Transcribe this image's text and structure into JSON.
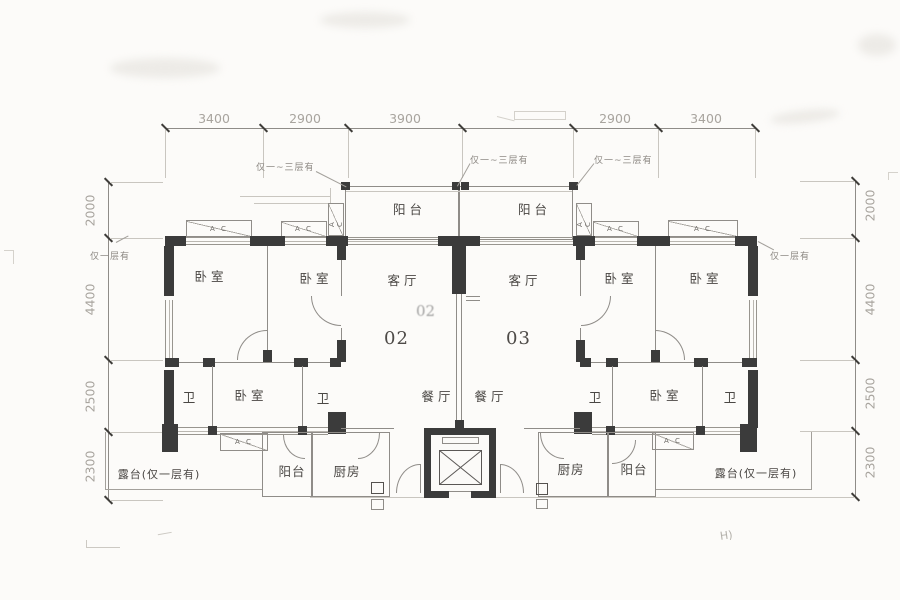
{
  "drawing_type": "apartment floor plan",
  "colors": {
    "background": "#fcfbf9",
    "wall": "#3b3b3b",
    "line": "#8f8c88",
    "light_line": "#c9c6c0",
    "dim_text": "#a8a49e",
    "label_text": "#4a4744"
  },
  "dimensions": {
    "top": [
      "3400",
      "2900",
      "3900",
      "2900",
      "3400"
    ],
    "left": [
      "2000",
      "4400",
      "2500",
      "2300"
    ],
    "right": [
      "2000",
      "4400",
      "2500",
      "2300"
    ]
  },
  "units": {
    "left": "02",
    "right": "03",
    "ghost": "02"
  },
  "rooms": {
    "bedroom": "卧室",
    "living_room": "客厅",
    "dining_room": "餐厅",
    "bathroom": "卫",
    "kitchen": "厨房",
    "balcony": "阳台",
    "terrace": "露台(仅一层有)"
  },
  "equipment": {
    "ac_unit": "A C"
  },
  "annotations": {
    "only_floors_1_3": "仅一~三层有",
    "only_floor_1": "仅一层有",
    "handwritten_mark": "H)"
  }
}
